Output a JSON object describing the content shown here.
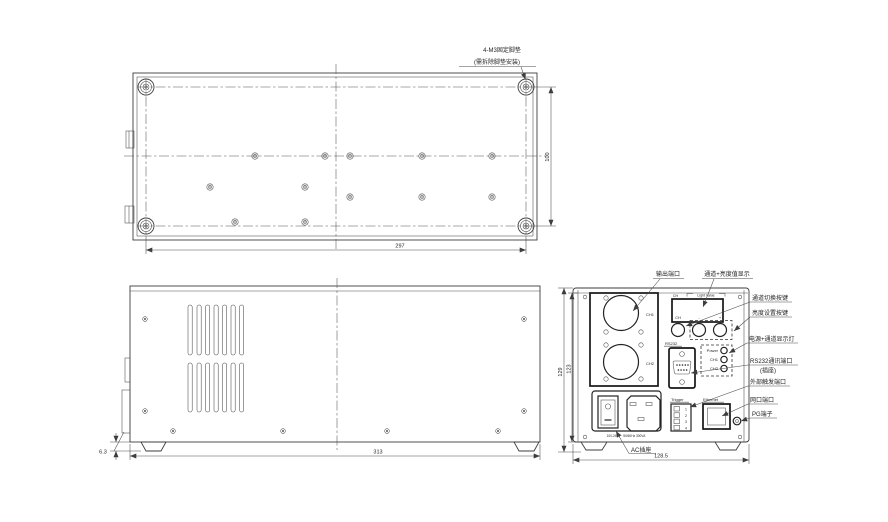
{
  "colors": {
    "line": "#3d3d3d",
    "text": "#1f1f1f",
    "background": "#ffffff"
  },
  "bottom_view": {
    "note_line1": "4-M3固定脚垫",
    "note_line2": "(需拆除脚垫安装)",
    "dim_width": "297",
    "dim_depth": "100"
  },
  "side_view": {
    "dim_width": "313",
    "dim_foot_height": "6.3"
  },
  "front_view": {
    "dim_height_outer": "129",
    "dim_height_inner": "123",
    "dim_width": "128.5",
    "panel": {
      "ch1_label": "CH1",
      "ch2_label": "CH2",
      "display_ch_label": "CH",
      "display_value_label": "Light Value",
      "button_ch_label": "CH",
      "button_minus_label": "-",
      "button_plus_label": "+",
      "rs232_label": "RS232",
      "led_power_label": "Power",
      "led_ch1_label": "CH1",
      "led_ch2_label": "CH2",
      "trigger_label": "Trigger",
      "trigger_pins": [
        "1",
        "2",
        "3",
        "4"
      ],
      "ethernet_label": "Ethernet",
      "ac_rating": "100-240V~ 50/60Hz 300VA"
    },
    "callouts": {
      "output_port": "输出端口",
      "display": "通道+亮度值显示",
      "channel_switch": "通道切换按键",
      "brightness_set": "亮度设置按键",
      "power_leds": "电源+通道显示灯",
      "rs232_line1": "RS232通讯端口",
      "rs232_line2": "(插座)",
      "trigger": "外部触发端口",
      "ethernet": "网口端口",
      "pg": "PG端子",
      "ac_socket": "AC插座"
    }
  }
}
